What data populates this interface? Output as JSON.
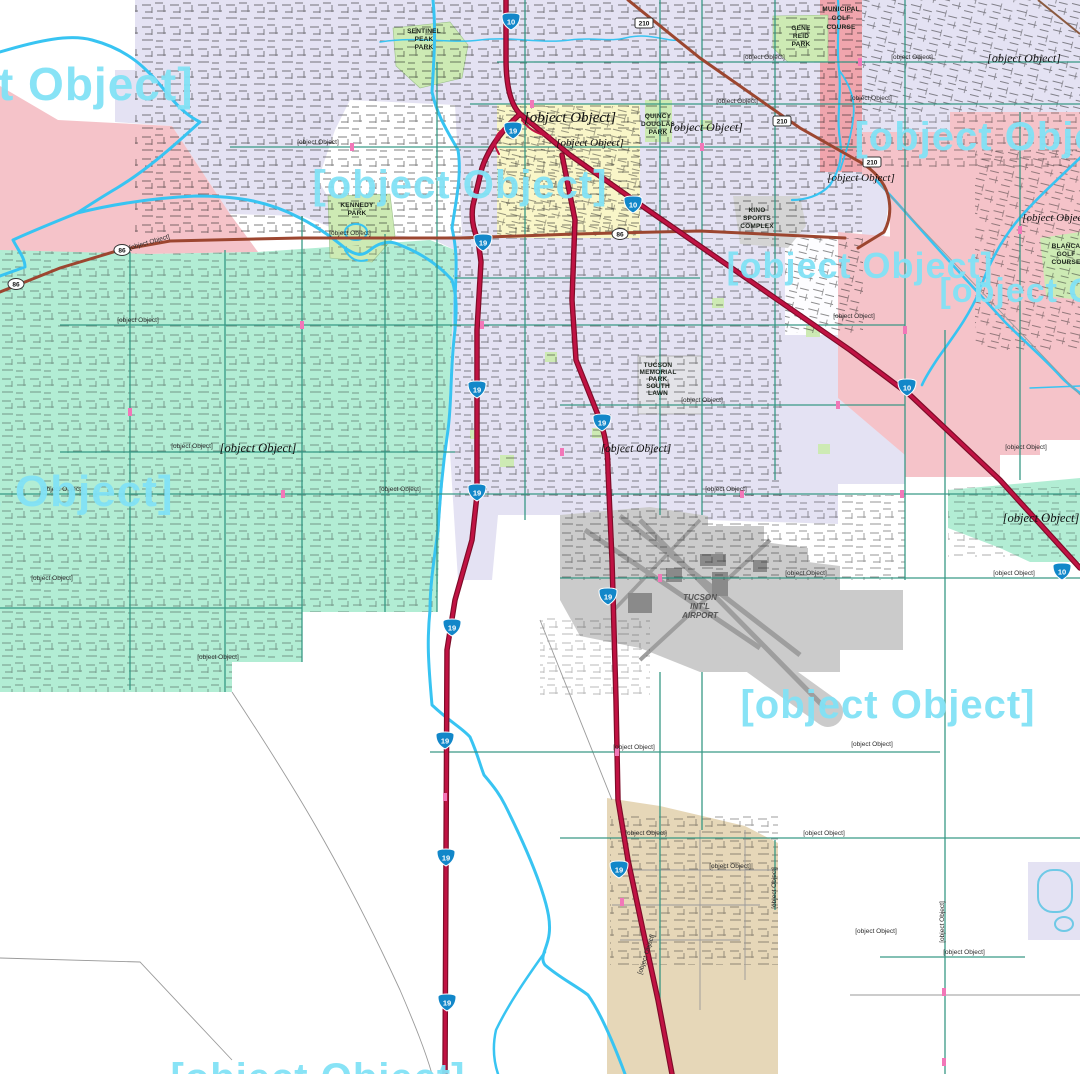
{
  "map": {
    "zips": [
      {
        "text": "5"
      },
      {
        "text": "85713"
      },
      {
        "text": "85711"
      },
      {
        "text": "85714"
      },
      {
        "text": "7"
      },
      {
        "text": "857"
      },
      {
        "text": "85706"
      },
      {
        "text": "85746"
      }
    ],
    "places": [
      {
        "text": "South Tucson"
      },
      {
        "text": "Junction Interstate Ninet"
      },
      {
        "text": "Pueblo Gardens"
      },
      {
        "text": "Craycroft"
      },
      {
        "text": "Polvo"
      },
      {
        "text": "Vandenburg Village"
      },
      {
        "text": "Drexel Heights"
      },
      {
        "text": "Emery Park"
      },
      {
        "text": "Littletown"
      }
    ],
    "parks": [
      {
        "lines": [
          "MUNICIPAL",
          "GOLF",
          "COURSE"
        ]
      },
      {
        "lines": [
          "SENTINEL",
          "PEAK",
          "PARK"
        ]
      },
      {
        "lines": [
          "GENE",
          "REID",
          "PARK"
        ]
      },
      {
        "lines": [
          "QUINCY",
          "DOUGLAS",
          "PARK"
        ]
      },
      {
        "lines": [
          "KENNEDY",
          "PARK"
        ]
      },
      {
        "lines": [
          "KINO",
          "SPORTS",
          "COMPLEX"
        ]
      },
      {
        "lines": [
          "BLANCA",
          "GOLF",
          "COURSE"
        ]
      },
      {
        "lines": [
          "TUCSON",
          "MEMORIAL",
          "PARK",
          "SOUTH",
          "LAWN"
        ]
      },
      {
        "lines": [
          "TUCSON",
          "INT'L",
          "AIRPORT"
        ]
      }
    ],
    "roads": [
      {
        "text": "W Ajo Way"
      },
      {
        "text": "W Ajo Way"
      },
      {
        "text": "W 36th St"
      },
      {
        "text": "E 22nd St"
      },
      {
        "text": "E 22nd St"
      },
      {
        "text": "E 29th St"
      },
      {
        "text": "Silverlake Rd"
      },
      {
        "text": "W Irvington Rd"
      },
      {
        "text": "E Irvington Rd"
      },
      {
        "text": "W Bilby Rd"
      },
      {
        "text": "W Valencia Rd"
      },
      {
        "text": "W Valencia Rd"
      },
      {
        "text": "E Valencia Rd"
      },
      {
        "text": "E Valencia Rd"
      },
      {
        "text": "E Drexel Rd"
      },
      {
        "text": "W Los Reales Rd"
      },
      {
        "text": "E Los Reales Rd"
      },
      {
        "text": "E Los Reales Rd"
      },
      {
        "text": "W Hermans Rd"
      },
      {
        "text": "E Hughes Access Rd"
      },
      {
        "text": "E Hughes Access Rd"
      },
      {
        "text": "E Old Vail Connection Rd"
      },
      {
        "text": "E Nogales Old Vail Connection Rd"
      },
      {
        "text": "E Wooden Bucket Dr"
      },
      {
        "text": "E Whispering Sage Rd"
      },
      {
        "text": "E Singing Cactus Ln"
      },
      {
        "text": "S Swan Rd"
      },
      {
        "text": "S Country Club Rd"
      },
      {
        "text": "Old Nogales Hwy"
      }
    ],
    "shields": {
      "interstate": [
        "10",
        "10",
        "10",
        "10",
        "19",
        "19",
        "19",
        "19",
        "19",
        "19",
        "19",
        "19",
        "19",
        "19",
        "19"
      ],
      "us86": [
        "86",
        "86",
        "86"
      ],
      "sr210": [
        "210",
        "210",
        "210"
      ]
    },
    "colors": {
      "water": "#38c4f2",
      "interstate_red": "#bb1140",
      "zip_text": "#82e2f6",
      "mint": "#b2edd4",
      "pink": "#f5c3c9",
      "lavender": "#e4e2f3",
      "tan": "#e6d7b8",
      "park_green": "#cdeab4",
      "south_tucson_yellow": "#f9f6c8",
      "major_road_teal": "#2f9480",
      "airport_gray": "#cbcbcb"
    }
  }
}
